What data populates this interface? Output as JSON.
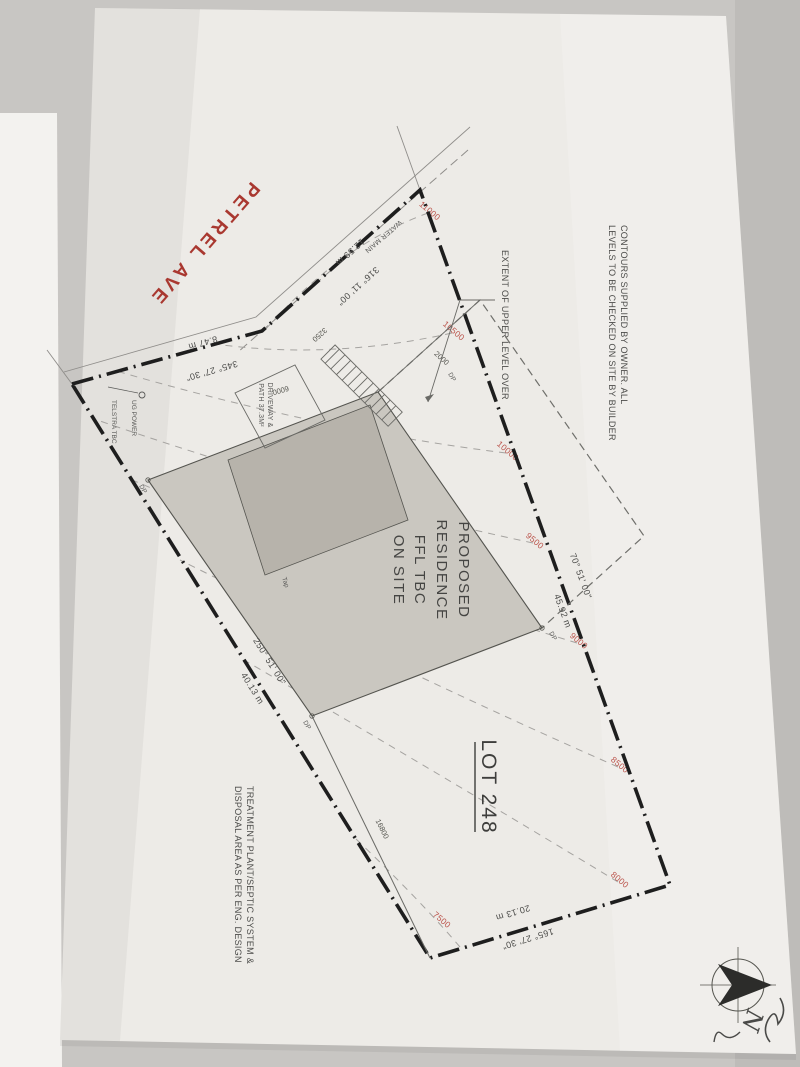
{
  "document": {
    "kind": "site plan"
  },
  "notes": {
    "contours_line1": "CONTOURS SUPPLIED BY OWNER.  ALL",
    "contours_line2": "LEVELS TO BE CHECKED ON SITE BY BUILDER",
    "treatment_line1": "TREATMENT PLANT/SEPTIC SYSTEM &",
    "treatment_line2": "DISPOSAL AREA AS PER ENG. DESIGN",
    "extent_upper": "EXTENT OF UPPER LEVEL OVER"
  },
  "street": {
    "name": "PETREL AVE"
  },
  "lot": {
    "number": "LOT 248"
  },
  "residence": {
    "line1": "PROPOSED",
    "line2": "RESIDENCE",
    "line3": "FFL TBC",
    "line4": "ON SITE"
  },
  "driveway": {
    "line1": "DRIVEWAY &",
    "line2": "PATH 37.3M²"
  },
  "services": {
    "water_main": "WATER MAIN",
    "telstra": "TELSTRA TBC",
    "ug_power": "UG POWER",
    "tap": "Tap",
    "downpipe": "DP"
  },
  "boundaries": [
    {
      "bearing": "345° 27' 30\"",
      "distance": "8.47 m"
    },
    {
      "bearing": "316° 11' 00\"",
      "distance": "12.59 m"
    },
    {
      "bearing": "70° 51' 00\"",
      "distance": "45.92 m"
    },
    {
      "bearing": "165° 27' 30\"",
      "distance": "20.13 m"
    },
    {
      "bearing": "250° 51' 00\"",
      "distance": "40.13 m"
    }
  ],
  "contour_labels": {
    "c11000": "11000",
    "c10500": "10500",
    "c10000": "10000",
    "c9500": "9500",
    "c9000": "9000",
    "c8500": "8500",
    "c8000": "8000",
    "c7500": "7500"
  },
  "dimensions": {
    "upper_level_offset": "2000",
    "driveway_width": "6000",
    "setback": "3250",
    "rear_line": "16800"
  },
  "north": {
    "letter": "N"
  }
}
